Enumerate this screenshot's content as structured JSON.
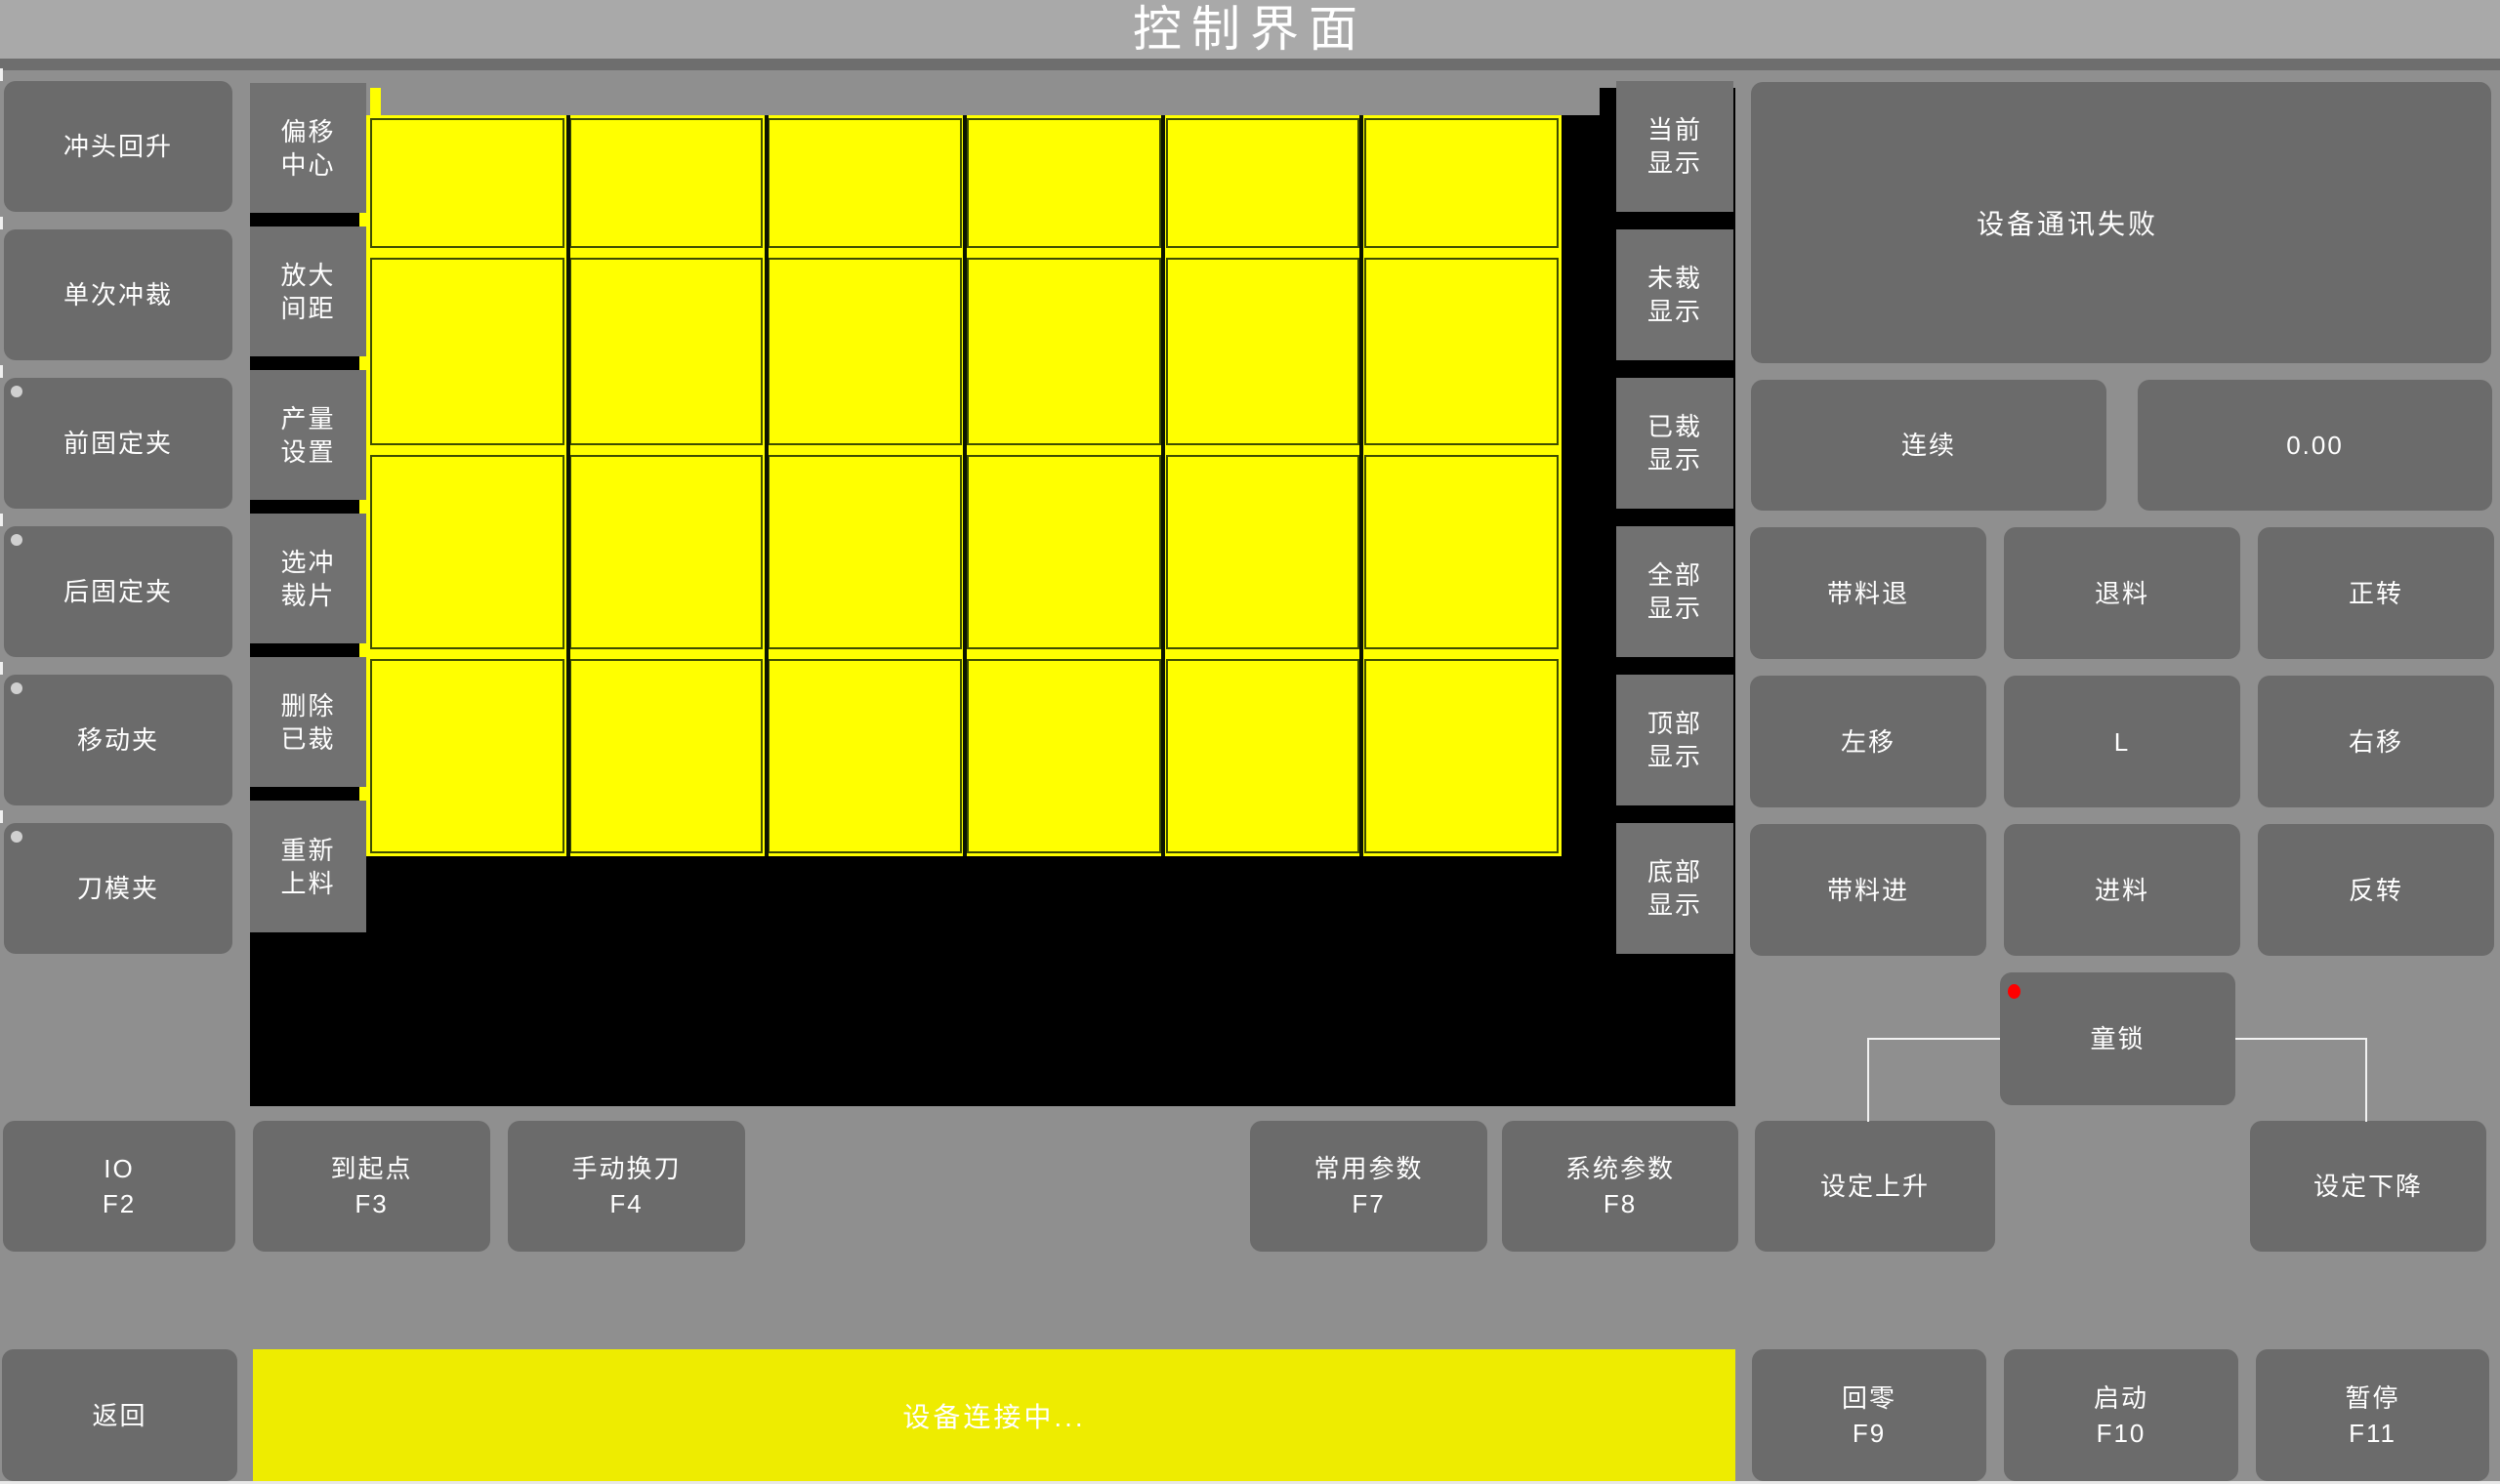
{
  "title": "控制界面",
  "left_column": {
    "items": [
      {
        "label": "冲头回升",
        "dot": false
      },
      {
        "label": "单次冲裁",
        "dot": false
      },
      {
        "label": "前固定夹",
        "dot": true
      },
      {
        "label": "后固定夹",
        "dot": true
      },
      {
        "label": "移动夹",
        "dot": true
      },
      {
        "label": "刀模夹",
        "dot": true
      }
    ]
  },
  "tool_column": {
    "items": [
      {
        "label": "偏移\n中心"
      },
      {
        "label": "放大\n间距"
      },
      {
        "label": "产量\n设置"
      },
      {
        "label": "选冲\n裁片"
      },
      {
        "label": "删除\n已裁"
      },
      {
        "label": "重新\n上料"
      }
    ]
  },
  "display_column": {
    "items": [
      {
        "label": "当前\n显示"
      },
      {
        "label": "未裁\n显示"
      },
      {
        "label": "已裁\n显示"
      },
      {
        "label": "全部\n显示"
      },
      {
        "label": "顶部\n显示"
      },
      {
        "label": "底部\n显示"
      }
    ]
  },
  "sheet": {
    "rows": 4,
    "cols": 6,
    "pieces_state": "uncut"
  },
  "right_panel": {
    "message": "设备通讯失败",
    "mode_button": "连续",
    "value_display": "0.00",
    "jog_grid": [
      [
        "带料退",
        "退料",
        "正转"
      ],
      [
        "左移",
        "L",
        "右移"
      ],
      [
        "带料进",
        "进料",
        "反转"
      ]
    ],
    "child_lock": "童锁"
  },
  "function_row": {
    "left": [
      {
        "label": "IO",
        "key": "F2"
      },
      {
        "label": "到起点",
        "key": "F3"
      },
      {
        "label": "手动换刀",
        "key": "F4"
      }
    ],
    "right": [
      {
        "label": "常用参数",
        "key": "F7"
      },
      {
        "label": "系统参数",
        "key": "F8"
      }
    ],
    "set_up": "设定上升",
    "set_down": "设定下降"
  },
  "bottom_bar": {
    "back": "返回",
    "status": "设备连接中...",
    "keys": [
      {
        "label": "回零",
        "key": "F9"
      },
      {
        "label": "启动",
        "key": "F10"
      },
      {
        "label": "暂停",
        "key": "F11"
      }
    ]
  },
  "colors": {
    "sheet_yellow": "#ffff00",
    "status_yellow": "#eeec00",
    "alert_red": "#ff0000",
    "indicator_gray": "#d0d0d0",
    "sheet_line": "#3e4d00"
  }
}
